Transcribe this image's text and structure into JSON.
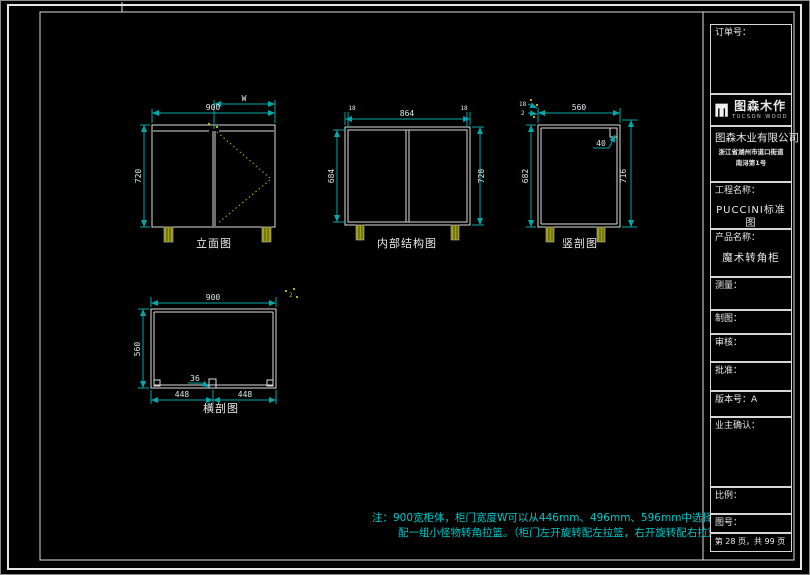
{
  "title_block": {
    "order_label": "订单号：",
    "logo": {
      "name": "图森木作",
      "subtitle": "TUCSON WOOD"
    },
    "company": {
      "name": "图森木业有限公司",
      "address_line1": "浙江省湖州市道口街道",
      "address_line2": "南浔第1号"
    },
    "project_label": "工程名称：",
    "project_value": "PUCCINI标准图",
    "product_label": "产品名称：",
    "product_value": "魔术转角柜",
    "measure_label": "测量：",
    "draft_label": "制图：",
    "review_label": "审核：",
    "approve_label": "批准：",
    "version_label": "版本号：",
    "version_value": "A",
    "owner_label": "业主确认：",
    "scale_label": "比例：",
    "drawing_no_label": "图号：",
    "page_label": "第 28 页，共 99 页"
  },
  "views": {
    "elevation": {
      "label": "立面图",
      "dim_width": "900",
      "dim_door": "W",
      "dim_height": "720"
    },
    "internal": {
      "label": "内部结构图",
      "dim_top_left": "18",
      "dim_inner_width": "864",
      "dim_top_right": "18",
      "dim_left_height": "684",
      "dim_right_height": "720"
    },
    "vertical_section": {
      "label": "竖剖图",
      "dim_depth": "560",
      "dim_left": "682",
      "dim_right": "716",
      "dim_back_rail": "40",
      "dim_small_a": "18",
      "dim_small_b": "2"
    },
    "horizontal_section": {
      "label": "横剖图",
      "dim_width": "900",
      "dim_depth": "560",
      "dim_left_half": "448",
      "dim_right_half": "448",
      "dim_partition": "36",
      "mark": "2"
    }
  },
  "notes": {
    "line1": "注：900宽柜体，柜门宽度W可以从446mm、496mm、596mm中选择，",
    "line2": "配一组小怪物转角拉篮。（柜门左开旋转配左拉篮，右开旋转配右拉篮）"
  },
  "colors": {
    "background": "#000000",
    "line": "#dcdcdc",
    "dimension": "#00a9a9",
    "note": "#00c6c6",
    "accent_yellow": "#b8b400"
  }
}
